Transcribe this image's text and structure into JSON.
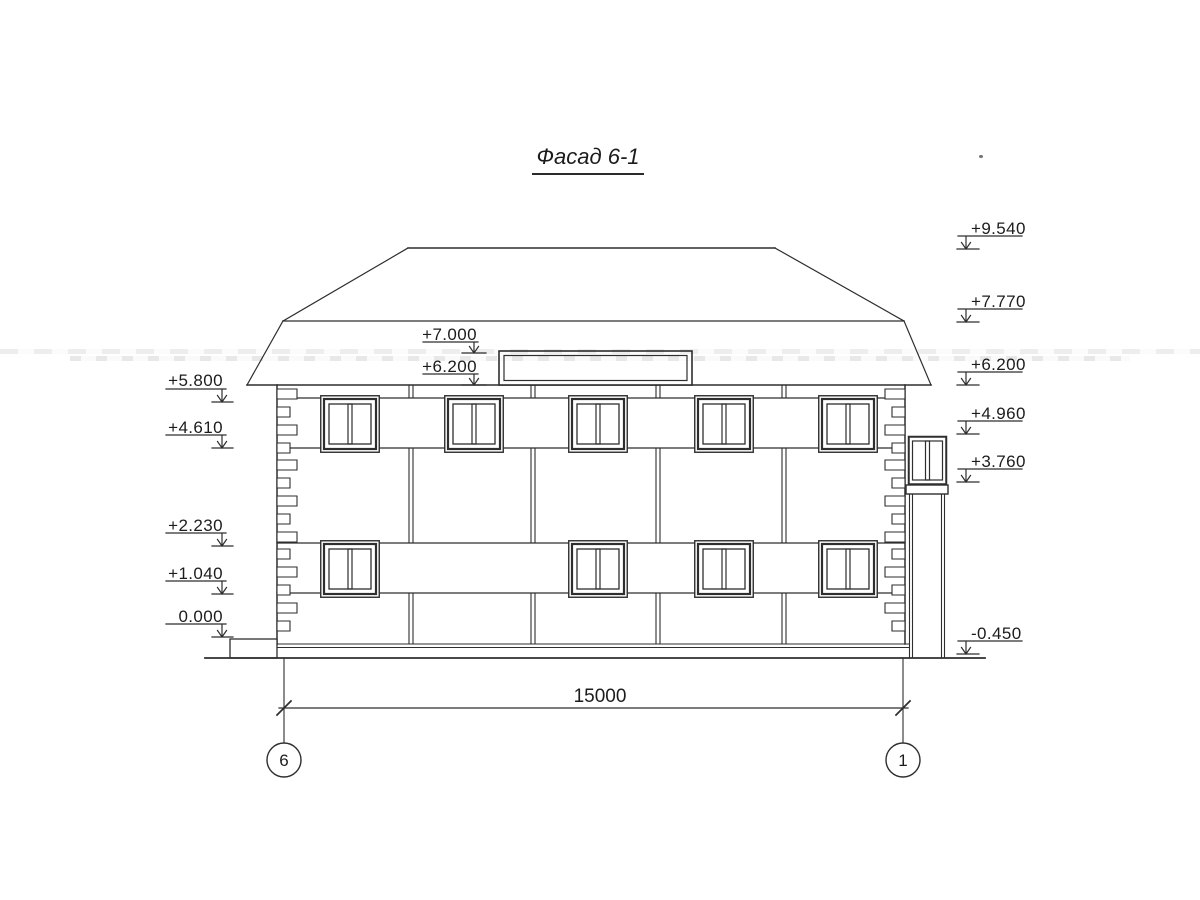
{
  "title": "Фасад 6-1",
  "annotations": {
    "dimension": "15000",
    "axis_left": "6",
    "axis_right": "1"
  },
  "elevations": {
    "left": [
      "+5.800",
      "+4.610",
      "+2.230",
      "+1.040",
      "0.000"
    ],
    "middle": [
      "+7.000",
      "+6.200"
    ],
    "right": [
      "+9.540",
      "+7.770",
      "+6.200",
      "+4.960",
      "+3.760",
      "-0.450"
    ]
  }
}
